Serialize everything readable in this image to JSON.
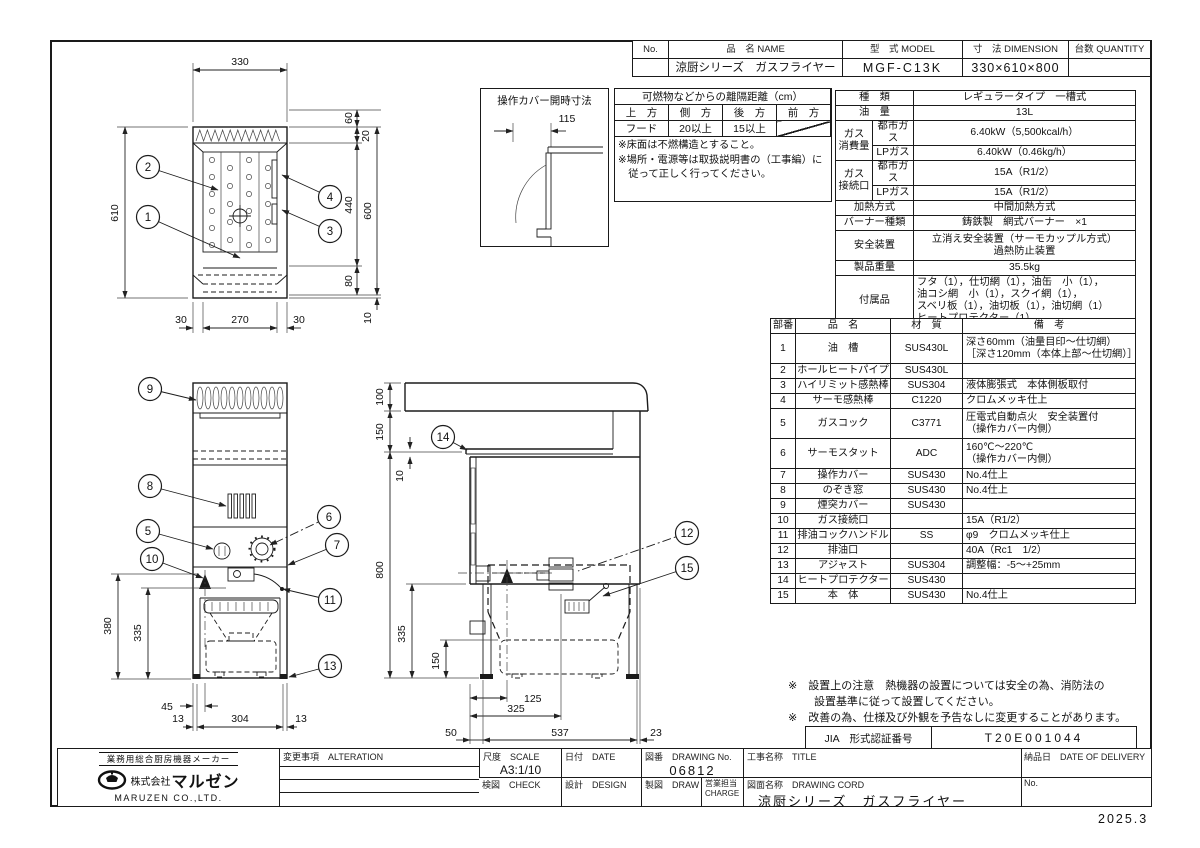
{
  "doc": {
    "date_note": "2025.3"
  },
  "header_table": {
    "h_no": "No.",
    "h_name": "品　名 NAME",
    "h_model": "型　式 MODEL",
    "h_dim": "寸　法 DIMENSION",
    "h_qty": "台数 QUANTITY",
    "v_no": "",
    "v_name": "涼厨シリーズ　ガスフライヤー",
    "v_model": "MGF-C13K",
    "v_dim": "330×610×800",
    "v_qty": ""
  },
  "clearance": {
    "title": "可燃物などからの離隔距離（cm）",
    "h1": "上　方",
    "h2": "側　方",
    "h3": "後　方",
    "h4": "前　方",
    "r1": "フード",
    "r2": "20以上",
    "r3": "15以上",
    "note1": "※床面は不燃構造とすること。",
    "note2": "※場所・電源等は取扱説明書の（工事編）に",
    "note3": "　従って正しく行ってください。"
  },
  "cover_dim": {
    "title": "操作カバー開時寸法",
    "value": "115"
  },
  "spec": {
    "k1": "種　類",
    "v1": "レギュラータイプ　一槽式",
    "k2": "油　量",
    "v2": "13L",
    "k3": "ガス\n消費量",
    "k3a": "都市ガス",
    "v3": "6.40kW（5,500kcal/h）",
    "k3b": "LPガス",
    "v4": "6.40kW（0.46kg/h）",
    "k4": "ガス\n接続口",
    "k4a": "都市ガス",
    "v5": "15A（R1/2）",
    "k4b": "LPガス",
    "v6": "15A（R1/2）",
    "k5": "加熱方式",
    "v7": "中間加熱方式",
    "k6": "バーナー種類",
    "v8": "鋳鉄製　網式バーナー　×1",
    "k7": "安全装置",
    "v9": "立消え安全装置（サーモカップル方式）\n過熱防止装置",
    "k8": "製品重量",
    "v10": "35.5kg",
    "k9": "付属品",
    "v11": "フタ（1），仕切網（1），油缶　小（1），\n油コシ網　小（1），スクイ網（1），\nスベリ板（1），油切板（1），油切網（1）\nヒートプロテクター（1）"
  },
  "parts": {
    "h1": "部番",
    "h2": "品　名",
    "h3": "材　質",
    "h4": "備　考",
    "rows": [
      {
        "no": "1",
        "name": "油　槽",
        "mat": "SUS430L",
        "note": "深さ60mm（油量目印～仕切網）\n［深さ120mm（本体上部～仕切網）］"
      },
      {
        "no": "2",
        "name": "ホールヒートパイプ",
        "mat": "SUS430L",
        "note": ""
      },
      {
        "no": "3",
        "name": "ハイリミット感熱棒",
        "mat": "SUS304",
        "note": "液体膨張式　本体側板取付"
      },
      {
        "no": "4",
        "name": "サーモ感熱棒",
        "mat": "C1220",
        "note": "クロムメッキ仕上"
      },
      {
        "no": "5",
        "name": "ガスコック",
        "mat": "C3771",
        "note": "圧電式自動点火　安全装置付\n（操作カバー内側）"
      },
      {
        "no": "6",
        "name": "サーモスタット",
        "mat": "ADC",
        "note": "160℃～220℃\n（操作カバー内側）"
      },
      {
        "no": "7",
        "name": "操作カバー",
        "mat": "SUS430",
        "note": "No.4仕上"
      },
      {
        "no": "8",
        "name": "のぞき窓",
        "mat": "SUS430",
        "note": "No.4仕上"
      },
      {
        "no": "9",
        "name": "煙突カバー",
        "mat": "SUS430",
        "note": ""
      },
      {
        "no": "10",
        "name": "ガス接続口",
        "mat": "",
        "note": "15A（R1/2）"
      },
      {
        "no": "11",
        "name": "排油コックハンドル",
        "mat": "SS",
        "note": "φ9　クロムメッキ仕上"
      },
      {
        "no": "12",
        "name": "排油口",
        "mat": "",
        "note": "40A（Rc1　1/2）"
      },
      {
        "no": "13",
        "name": "アジャスト",
        "mat": "SUS304",
        "note": "調整幅：-5～+25mm"
      },
      {
        "no": "14",
        "name": "ヒートプロテクター",
        "mat": "SUS430",
        "note": ""
      },
      {
        "no": "15",
        "name": "本　体",
        "mat": "SUS430",
        "note": "No.4仕上"
      }
    ]
  },
  "notes": {
    "n1": "※　設置上の注意　熱機器の設置については安全の為、消防法の",
    "n2": "設置基準に従って設置してください。",
    "n3": "※　改善の為、仕様及び外観を予告なしに変更することがあります。"
  },
  "jia": {
    "label": "JIA　形式認証番号",
    "value": "T20E001044"
  },
  "tb": {
    "maker_tag": "業務用総合厨房機器メーカー",
    "company_prefix": "株式会社",
    "company": "マルゼン",
    "company_en": "MARUZEN CO.,LTD.",
    "alteration": "変更事項　ALTERATION",
    "scale_l": "尺度　SCALE",
    "scale_v": "A3:1/10",
    "date_l": "日付　DATE",
    "figno_l": "図番　DRAWING No.",
    "figno_v": "06812",
    "title_l": "工事名称　TITLE",
    "deliv_l": "納品日　DATE OF DELIVERY",
    "check_l": "検図　CHECK",
    "design_l": "設計　DESIGN",
    "draw_l": "製図　DRAW",
    "charge_l": "営業担当 CHARGE",
    "name_l": "図面名称　DRAWING CORD",
    "name_v": "涼厨シリーズ　ガスフライヤー",
    "no_l": "No."
  },
  "dims": {
    "plan": {
      "w": "330",
      "h": "610",
      "r60": "60",
      "r20": "20",
      "r440": "440",
      "r600": "600",
      "r80": "80",
      "r10": "10",
      "b30a": "30",
      "b270": "270",
      "b30b": "30"
    },
    "front": {
      "g380": "380",
      "d335": "335",
      "b45": "45",
      "b13a": "13",
      "b304": "304",
      "b13b": "13"
    },
    "side": {
      "t100": "100",
      "t150": "150",
      "t10": "10",
      "h800": "800",
      "d335": "335",
      "d150": "150",
      "b125": "125",
      "b325": "325",
      "c50": "50",
      "c537": "537",
      "c23": "23"
    }
  },
  "balloons": {
    "n1": "1",
    "n2": "2",
    "n3": "3",
    "n4": "4",
    "n5": "5",
    "n6": "6",
    "n7": "7",
    "n8": "8",
    "n9": "9",
    "n10": "10",
    "n11": "11",
    "n12": "12",
    "n13": "13",
    "n14": "14",
    "n15": "15"
  }
}
